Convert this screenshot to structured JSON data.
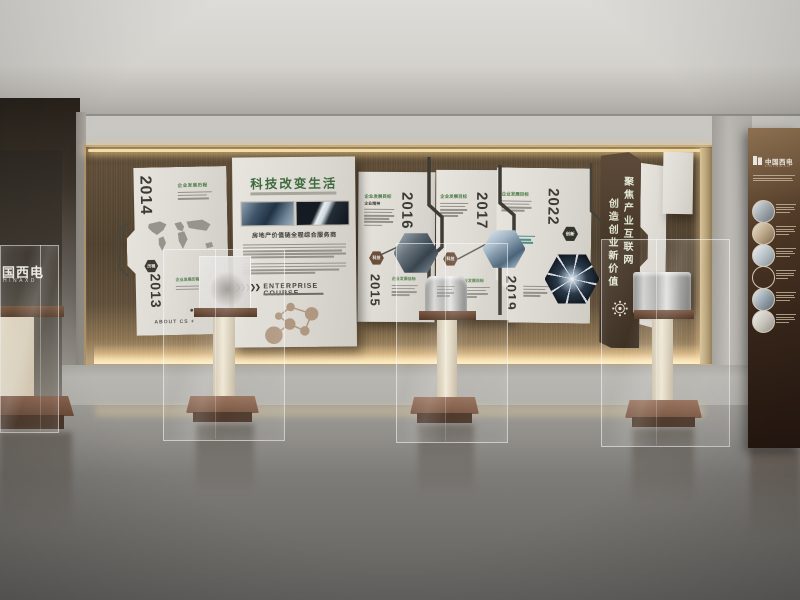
{
  "timeline": {
    "labels": {
      "goal": "企业发展目标",
      "history": "企业发展历程",
      "spirit": "企业精神"
    },
    "p2014": {
      "year_top": "2014",
      "year_bottom": "2013",
      "badge": "历程",
      "about": "ABOUT CS +"
    },
    "center": {
      "title": "科技改变生活",
      "tagline": "房地产价值链全程综合服务商",
      "course": "ENTERPRISE COURSE",
      "arrows": "❯❯❯❯❯"
    },
    "p2016": {
      "year_top": "2016",
      "year_bottom": "2015",
      "badge": "科技"
    },
    "p2017": {
      "year": "2017",
      "badge": "科技"
    },
    "p2022": {
      "year_top": "2022",
      "year_bottom": "2019",
      "badge": "创新"
    },
    "banner": {
      "col1": "聚焦产业互联网",
      "col2": "创造创业新价值"
    }
  },
  "left_case": {
    "brand": "国西电",
    "brand_en": "HINAXD"
  },
  "right_board": {
    "brand": "中国西电",
    "brand_en": "CHINAXD"
  },
  "colors": {
    "wood": "#6f5d45",
    "panel_white": "#e4e1da",
    "banner_brown": "#53412f",
    "accent_green": "#4a7a44",
    "badge_brown": "#6b4f3a",
    "floor_gray": "#7e7c78"
  }
}
